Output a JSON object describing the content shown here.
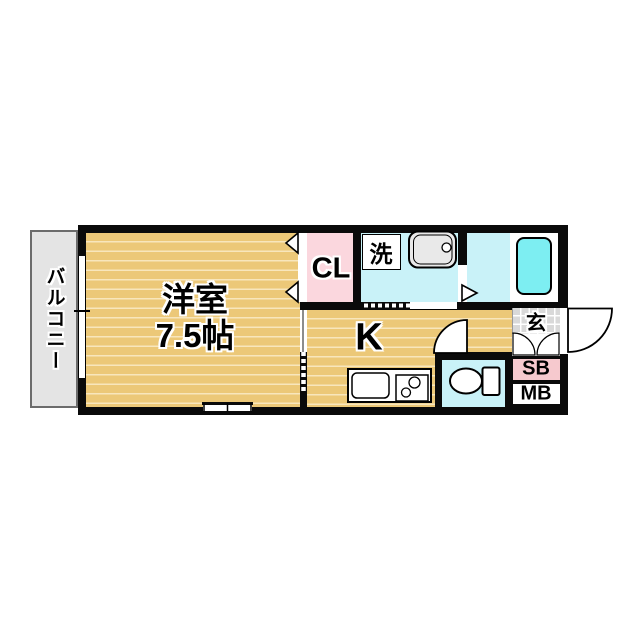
{
  "plan_type": "apartment-floor-plan-1K",
  "rooms": {
    "balcony": "バルコニー",
    "western_room_name": "洋室",
    "western_room_size": "7.5帖",
    "closet": "CL",
    "laundry": "洗",
    "kitchen": "K",
    "entrance": "玄",
    "shoe_box": "SB",
    "meter_box": "MB"
  },
  "colors": {
    "wall": "#0a0a0a",
    "wood_floor": "#ecc878",
    "wood_stripe": "#f8e6bc",
    "wet_area_floor": "#c9f2f8",
    "bathtub": "#7deef2",
    "closet_floor": "#fbd7de",
    "shoe_box_fill": "#f6c9ce",
    "balcony_floor": "#e4e4e4",
    "entrance_tile": "#d9d9d9"
  },
  "fixtures": [
    "bathtub",
    "wash-basin",
    "washing-machine-space",
    "toilet",
    "kitchen-sink",
    "gas-stove",
    "entrance-swing-door",
    "toilet-swing-door",
    "bathroom-swing-door",
    "closet-folding-door",
    "sliding-door",
    "balcony-window",
    "south-window",
    "shoe-box-double-door"
  ]
}
